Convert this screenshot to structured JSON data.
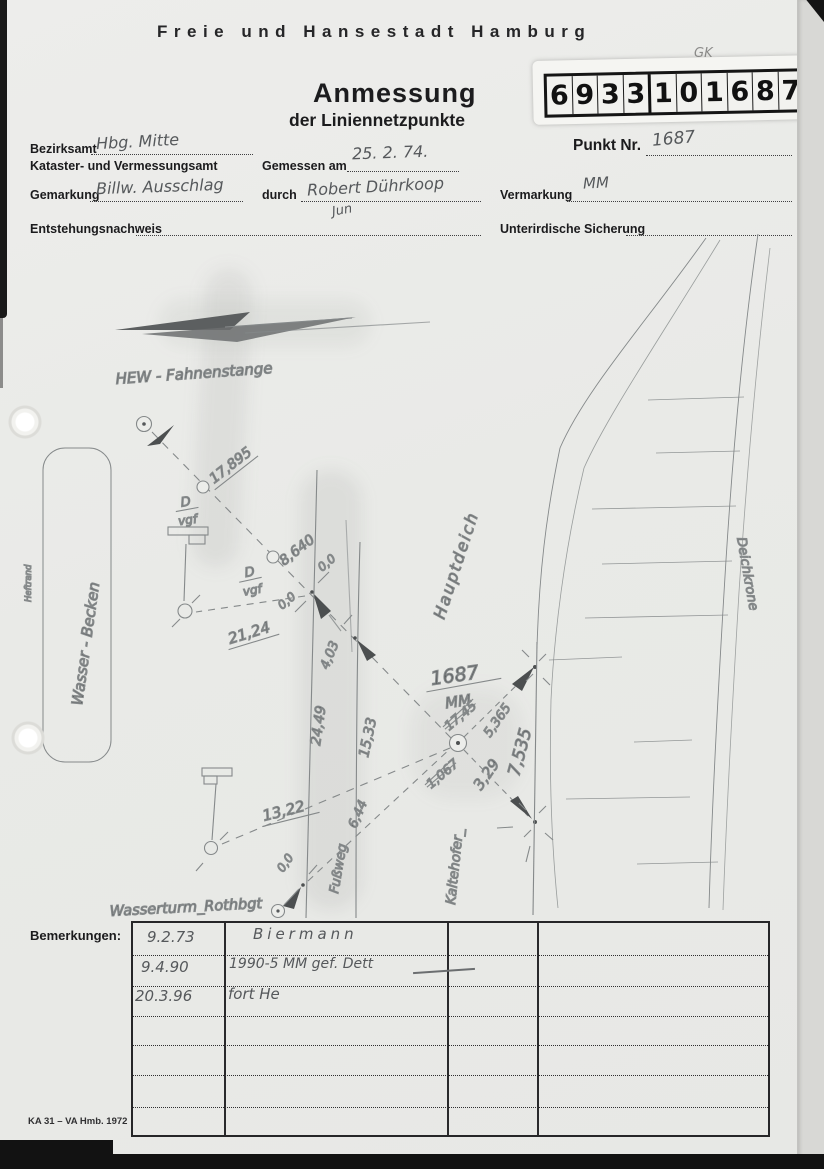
{
  "header": {
    "city": "Freie und Hansestadt Hamburg",
    "title": "Anmessung",
    "subtitle": "der Liniennetzpunkte",
    "stamp_digits": [
      "6",
      "9",
      "3",
      "3",
      "1",
      "0",
      "1",
      "6",
      "8",
      "7"
    ],
    "gk_note": "GK"
  },
  "form": {
    "bezirksamt_label": "Bezirksamt",
    "bezirksamt_value": "Hbg. Mitte",
    "amt_label": "Kataster- und Vermessungsamt",
    "gemessen_label": "Gemessen am",
    "gemessen_value": "25. 2. 74.",
    "punkt_label": "Punkt Nr.",
    "punkt_value": "1687",
    "gemarkung_label": "Gemarkung",
    "gemarkung_value": "Billw. Ausschlag",
    "durch_label": "durch",
    "durch_value": "Robert Dührkoop",
    "durch_signature": "Jun",
    "vermarkung_label": "Vermarkung",
    "vermarkung_value": "MM",
    "entstehung_label": "Entstehungsnachweis",
    "sicherung_label": "Unterirdische Sicherung"
  },
  "sketch": {
    "labels": {
      "hew": "HEW - Fahnenstange",
      "wasserturm": "Wasserturm_Rothbgt",
      "wasser_becken": "Wasser - Becken",
      "heftrand": "Heftrand",
      "hauptdeich": "Hauptdeich",
      "kaltehofer": "Kaltehofer_",
      "deichkrone": "Deichkrone",
      "fussweg": "Fußweg",
      "d_mark": "D",
      "vgf_mark": "vgf",
      "point_number": "1687",
      "point_mark": "MM",
      "zero": "0,0"
    },
    "measurements": {
      "hew_distance": "17,895",
      "m_8640": "8,640",
      "m_2124": "21,24",
      "m_403": "4,03",
      "m_2449": "24,49",
      "m_1533": "15,33",
      "m_644": "6,44",
      "m_1322": "13,22",
      "m_1745_crossed": "17,45",
      "m_1067_crossed": "1,067",
      "m_5365": "5,365",
      "m_329": "3,29",
      "m_7535": "7,535"
    }
  },
  "remarks": {
    "label": "Bemerkungen:",
    "rows": [
      {
        "date": "9.2.73",
        "text": "Biermann"
      },
      {
        "date": "9.4.90",
        "text": "1990-5 MM gef. Dett"
      },
      {
        "date": "20.3.96",
        "text": "fort He"
      }
    ]
  },
  "footer": {
    "form_id": "KA 31 – VA Hmb. 1972"
  }
}
